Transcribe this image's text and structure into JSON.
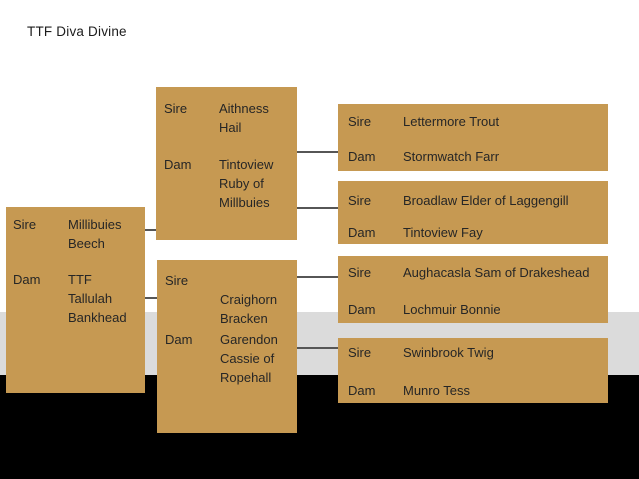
{
  "title": "TTF Diva Divine",
  "colors": {
    "box_fill": "#C69952",
    "gray_band": "#DBDBDB",
    "black_band": "#000000",
    "connector_line": "#565656"
  },
  "pedigree": {
    "boxes": {
      "parents": {
        "entries": [
          {
            "label": "Sire",
            "lines": [
              "Millibuies",
              "Beech"
            ]
          },
          {
            "label": "Dam",
            "lines": [
              "TTF",
              "Tallulah",
              "Bankhead"
            ]
          }
        ]
      },
      "sire_parents": {
        "entries": [
          {
            "label": "Sire",
            "lines": [
              "Aithness",
              "Hail"
            ]
          },
          {
            "label": "Dam",
            "lines": [
              "Tintoview",
              "Ruby of",
              "Millbuies"
            ]
          }
        ]
      },
      "dam_parents": {
        "entries": [
          {
            "label": "Sire",
            "lines": [
              "",
              "Craighorn",
              "Bracken"
            ]
          },
          {
            "label": "Dam",
            "lines": [
              "Garendon",
              "Cassie of",
              "Ropehall"
            ]
          }
        ]
      },
      "sire_grandparents_1": {
        "entries": [
          {
            "label": "Sire",
            "lines": [
              "Lettermore Trout"
            ]
          },
          {
            "label": "Dam",
            "lines": [
              "Stormwatch Farr"
            ]
          }
        ]
      },
      "sire_grandparents_2": {
        "entries": [
          {
            "label": "Sire",
            "lines": [
              "Broadlaw Elder of Laggengill"
            ]
          },
          {
            "label": "Dam",
            "lines": [
              "Tintoview Fay"
            ]
          }
        ]
      },
      "dam_grandparents_1": {
        "entries": [
          {
            "label": "Sire",
            "lines": [
              "Aughacasla Sam of Drakeshead"
            ]
          },
          {
            "label": "Dam",
            "lines": [
              "Lochmuir Bonnie"
            ]
          }
        ]
      },
      "dam_grandparents_2": {
        "entries": [
          {
            "label": "Sire",
            "lines": [
              "Swinbrook Twig"
            ]
          },
          {
            "label": "Dam",
            "lines": [
              "Munro Tess"
            ]
          }
        ]
      }
    }
  }
}
